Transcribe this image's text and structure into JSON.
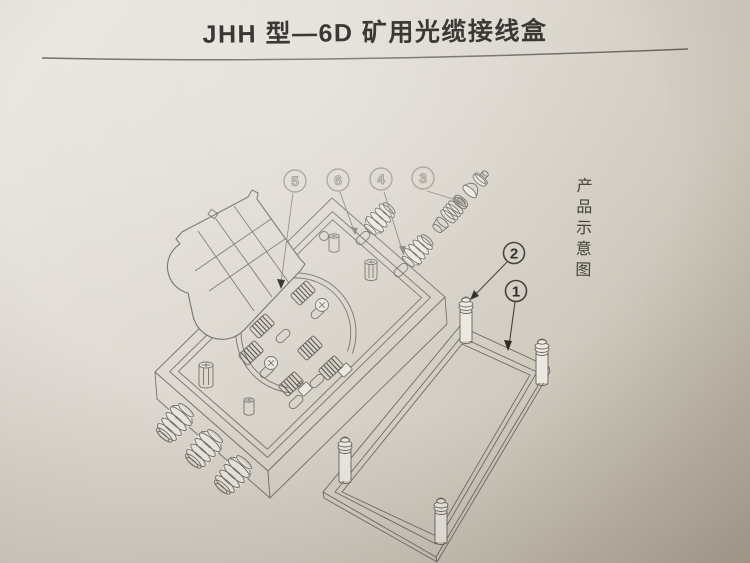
{
  "page": {
    "title": "JHH 型—6D 矿用光缆接线盒",
    "side_caption": "产品示意图"
  },
  "diagram": {
    "type": "exploded-line-drawing",
    "subject": "mining optical fiber cable junction box",
    "callouts": [
      "1",
      "2",
      "3",
      "4",
      "5",
      "6"
    ],
    "colors": {
      "paper_light": "#ebe8e2",
      "paper_dark": "#b2aa9c",
      "line": "#76726a",
      "dark_line": "#55524b",
      "callout_light": "#948f83",
      "callout_dark": "#2c2a26"
    }
  }
}
